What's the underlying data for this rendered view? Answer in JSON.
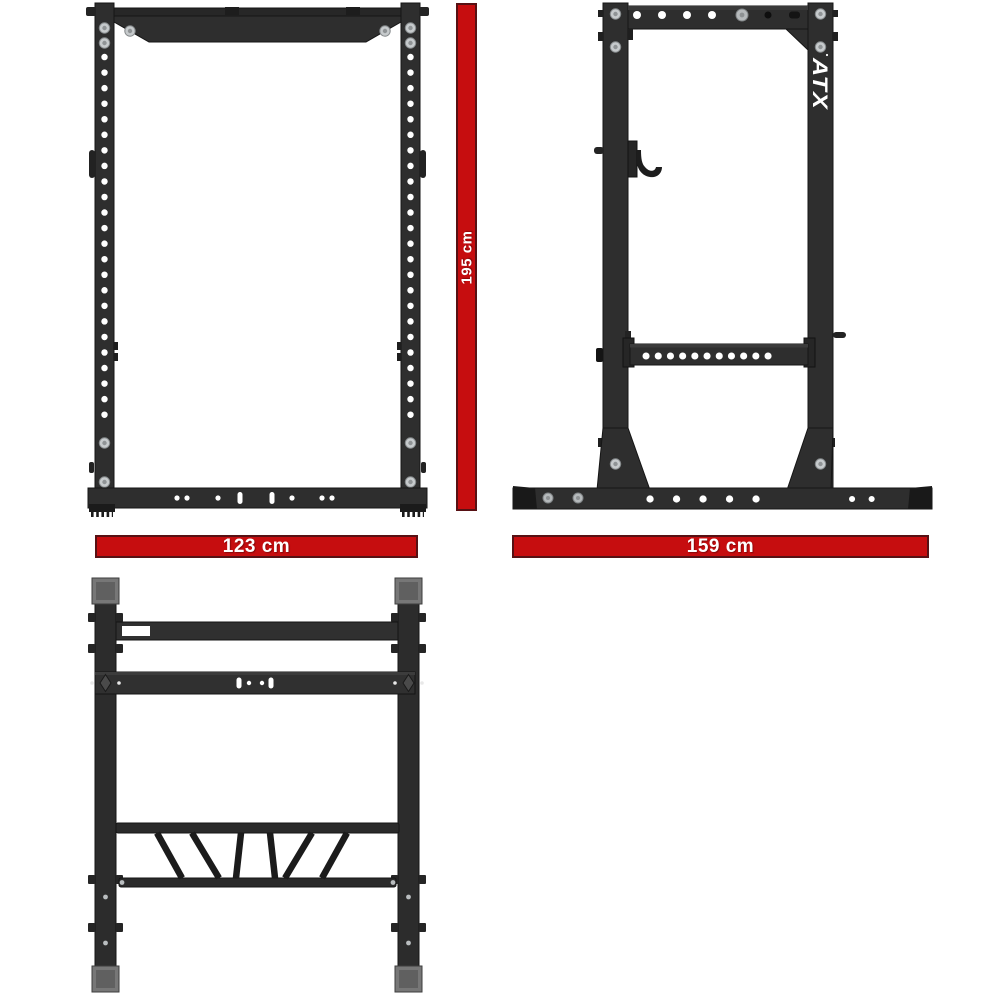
{
  "brand": {
    "logo": "ATX"
  },
  "dimensions": {
    "height": {
      "value": "195 cm"
    },
    "width": {
      "value": "123 cm"
    },
    "depth": {
      "value": "159 cm"
    }
  },
  "colors": {
    "accent-red": "#c60d0f",
    "red-border": "#571114",
    "frame": "#2e2e2e",
    "frame-dark": "#1c1c1c",
    "frame-stroke": "#151515",
    "bolt-gray": "#c6cacc",
    "cap-gray": "#777777",
    "hole-white": "#ffffff",
    "dim-text": "#ffffff"
  }
}
